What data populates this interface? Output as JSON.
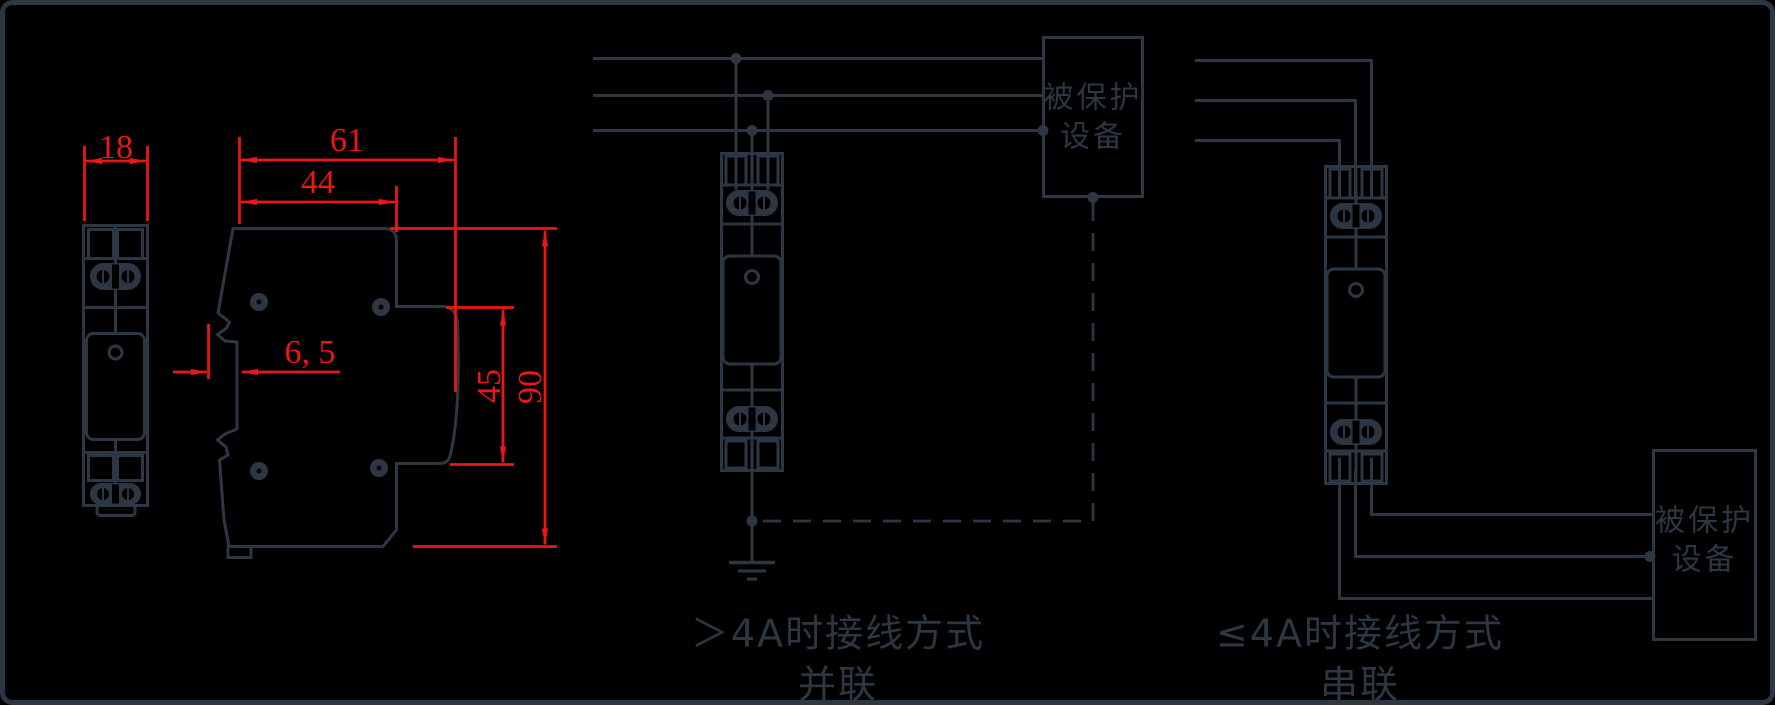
{
  "colors": {
    "background": "#000000",
    "drawing_line": "#2d3643",
    "dimension_red": "#ed1515"
  },
  "dimension_drawing": {
    "front_view_width": "18",
    "side_total_width": "61",
    "side_top_width": "44",
    "side_rail_offset": "6, 5",
    "side_step_height": "45",
    "side_total_height": "90"
  },
  "parallel_diagram": {
    "protected_device_line1": "被保护",
    "protected_device_line2": "设备",
    "caption_line1": "＞4A时接线方式",
    "caption_line2": "并联"
  },
  "series_diagram": {
    "protected_device_line1": "被保护",
    "protected_device_line2": "设备",
    "caption_line1": "≤4A时接线方式",
    "caption_line2": "串联"
  }
}
